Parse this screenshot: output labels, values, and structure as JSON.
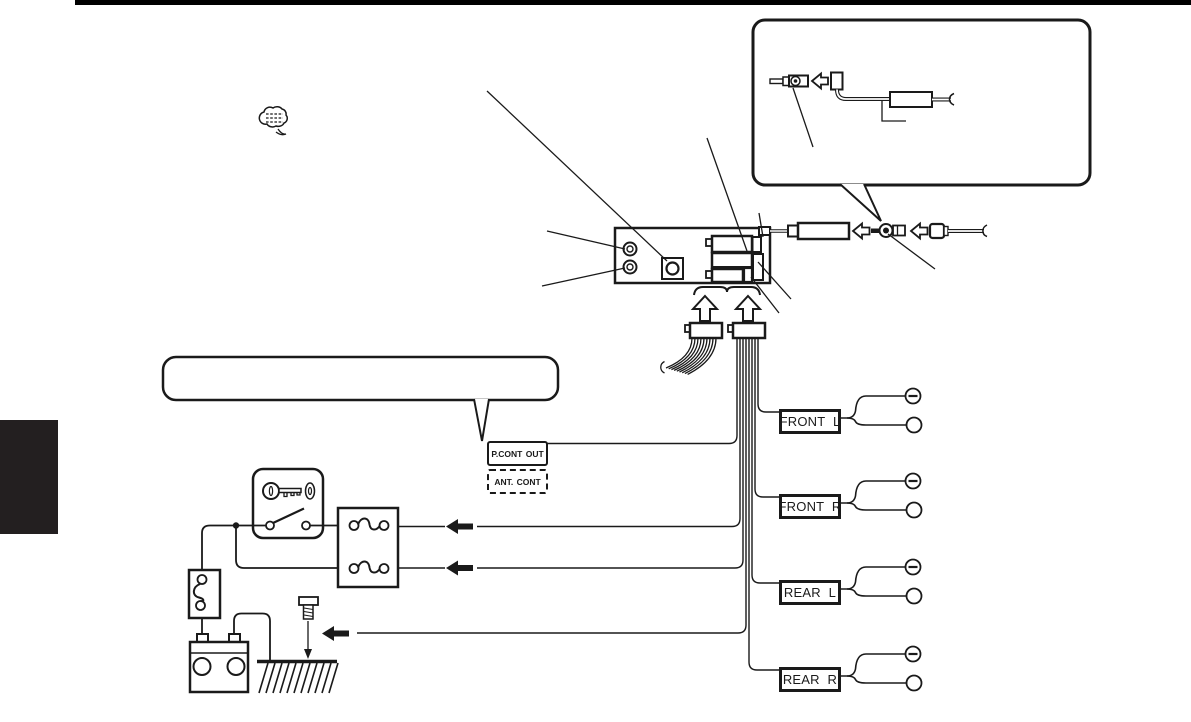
{
  "page": {
    "background": "#ffffff",
    "top_bar_color": "#000000",
    "side_tab_color": "#231f20",
    "line_color": "#1a1a1a"
  },
  "labels": {
    "p_cont_out": "P.CONT OUT",
    "ant_cont": "ANT. CONT"
  },
  "speakers": [
    {
      "label": "FRONT L"
    },
    {
      "label": "FRONT R"
    },
    {
      "label": "REAR L"
    },
    {
      "label": "REAR R"
    }
  ]
}
